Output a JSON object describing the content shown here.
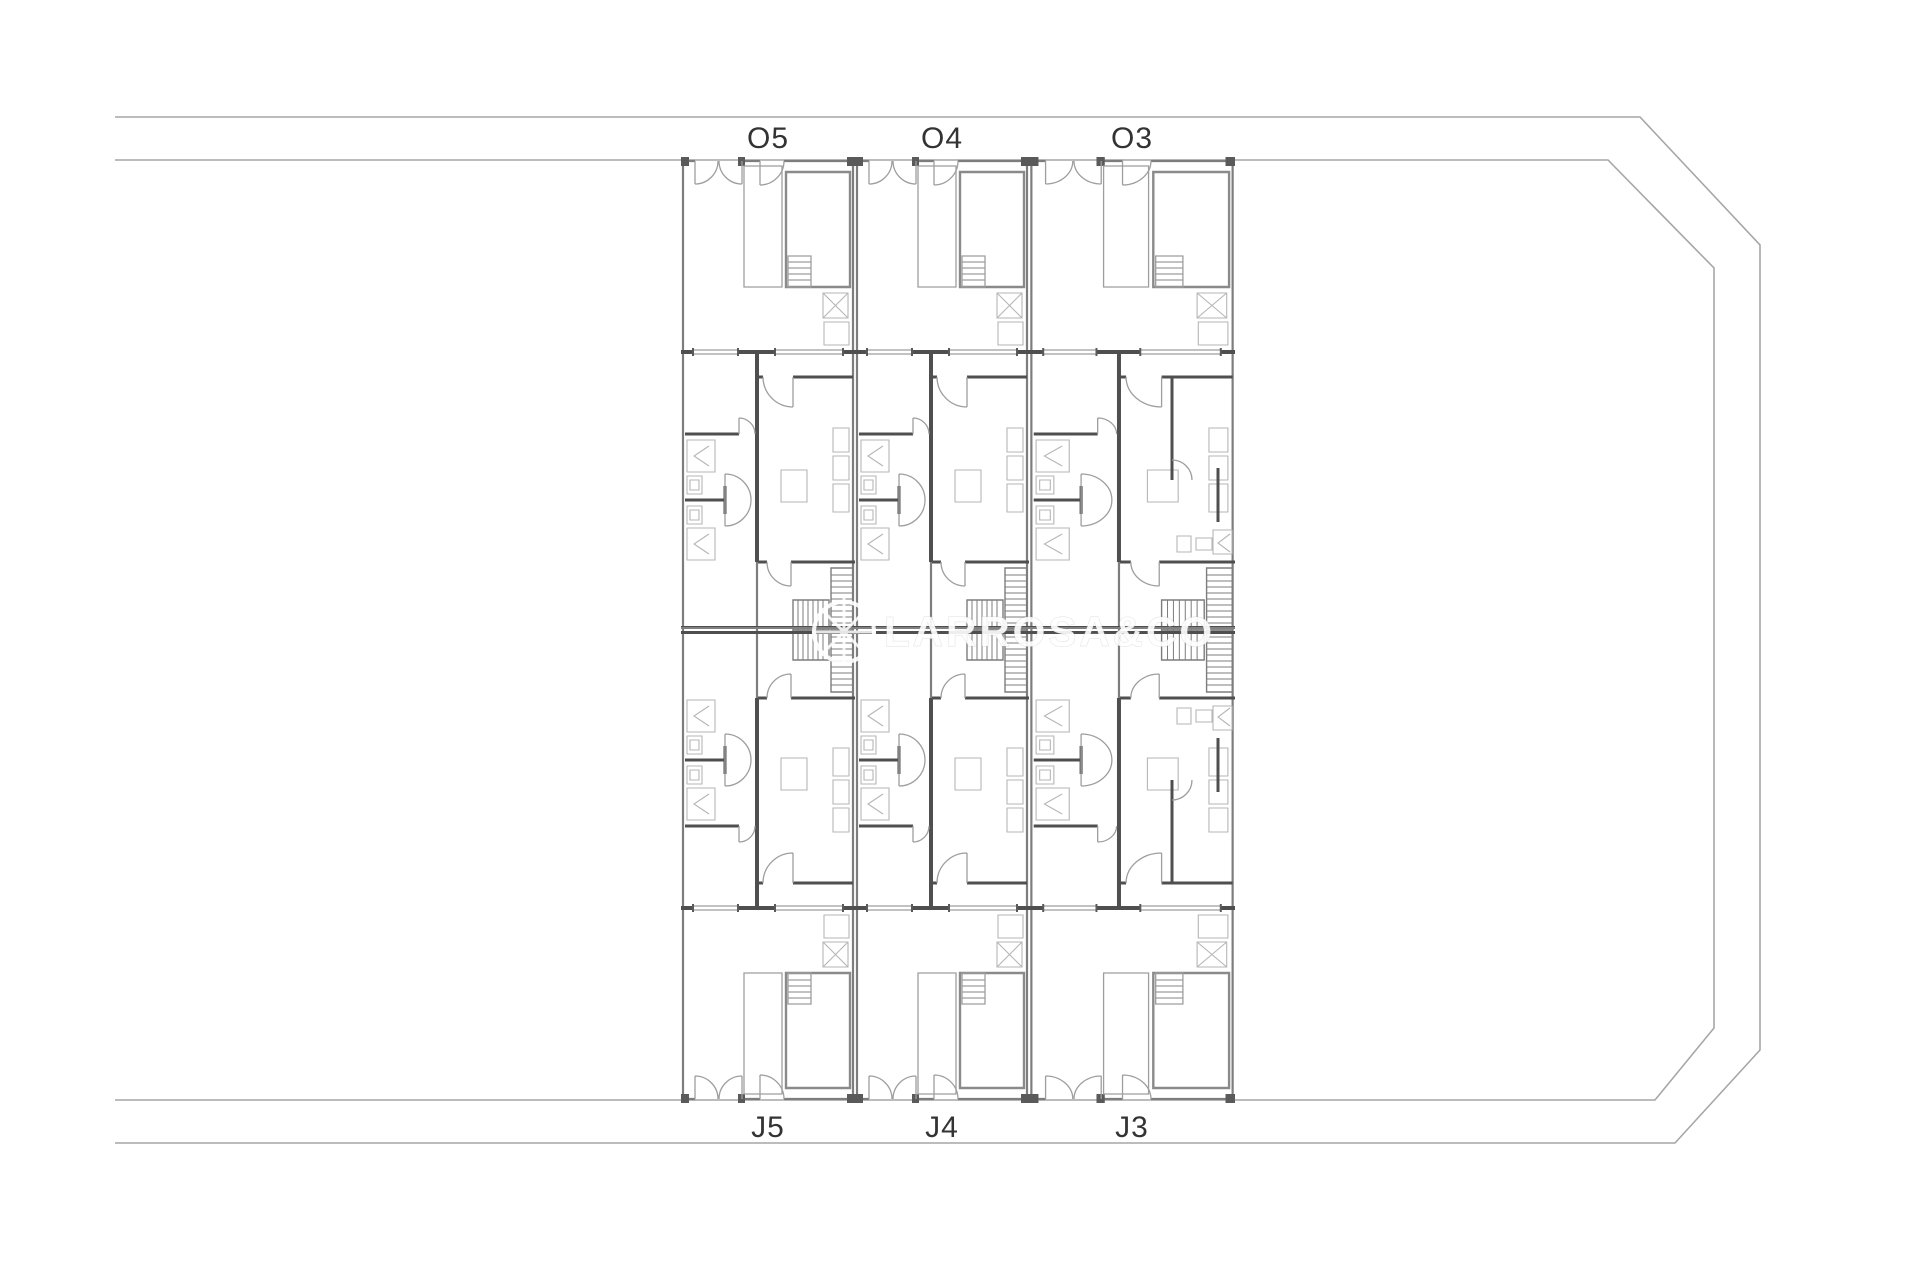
{
  "page": {
    "title": "Terraced houses site floor plan",
    "background": "#ffffff"
  },
  "plan": {
    "units_top": [
      {
        "id": "O5",
        "x": 768,
        "y": 138
      },
      {
        "id": "O4",
        "x": 942,
        "y": 138
      },
      {
        "id": "O3",
        "x": 1132,
        "y": 138
      }
    ],
    "units_bottom": [
      {
        "id": "J5",
        "x": 768,
        "y": 1126
      },
      {
        "id": "J4",
        "x": 942,
        "y": 1126
      },
      {
        "id": "J3",
        "x": 1132,
        "y": 1126
      }
    ],
    "label_font_size": 30,
    "label_color": "#333333",
    "rows": 2,
    "units_per_row": 3
  },
  "watermark": {
    "text": "LARROSA&CO",
    "logo": "compass-circle-icon",
    "color": "#ffffff",
    "opacity": 0.9
  },
  "colors": {
    "wall_dark": "#4f4f4f",
    "wall_mid": "#7d7d7d",
    "line_thin": "#9e9e9e",
    "furniture": "#b6b6b6",
    "boundary": "#a6a6a6",
    "pool": "#8a8a8a",
    "label": "#333333",
    "background": "#ffffff"
  }
}
